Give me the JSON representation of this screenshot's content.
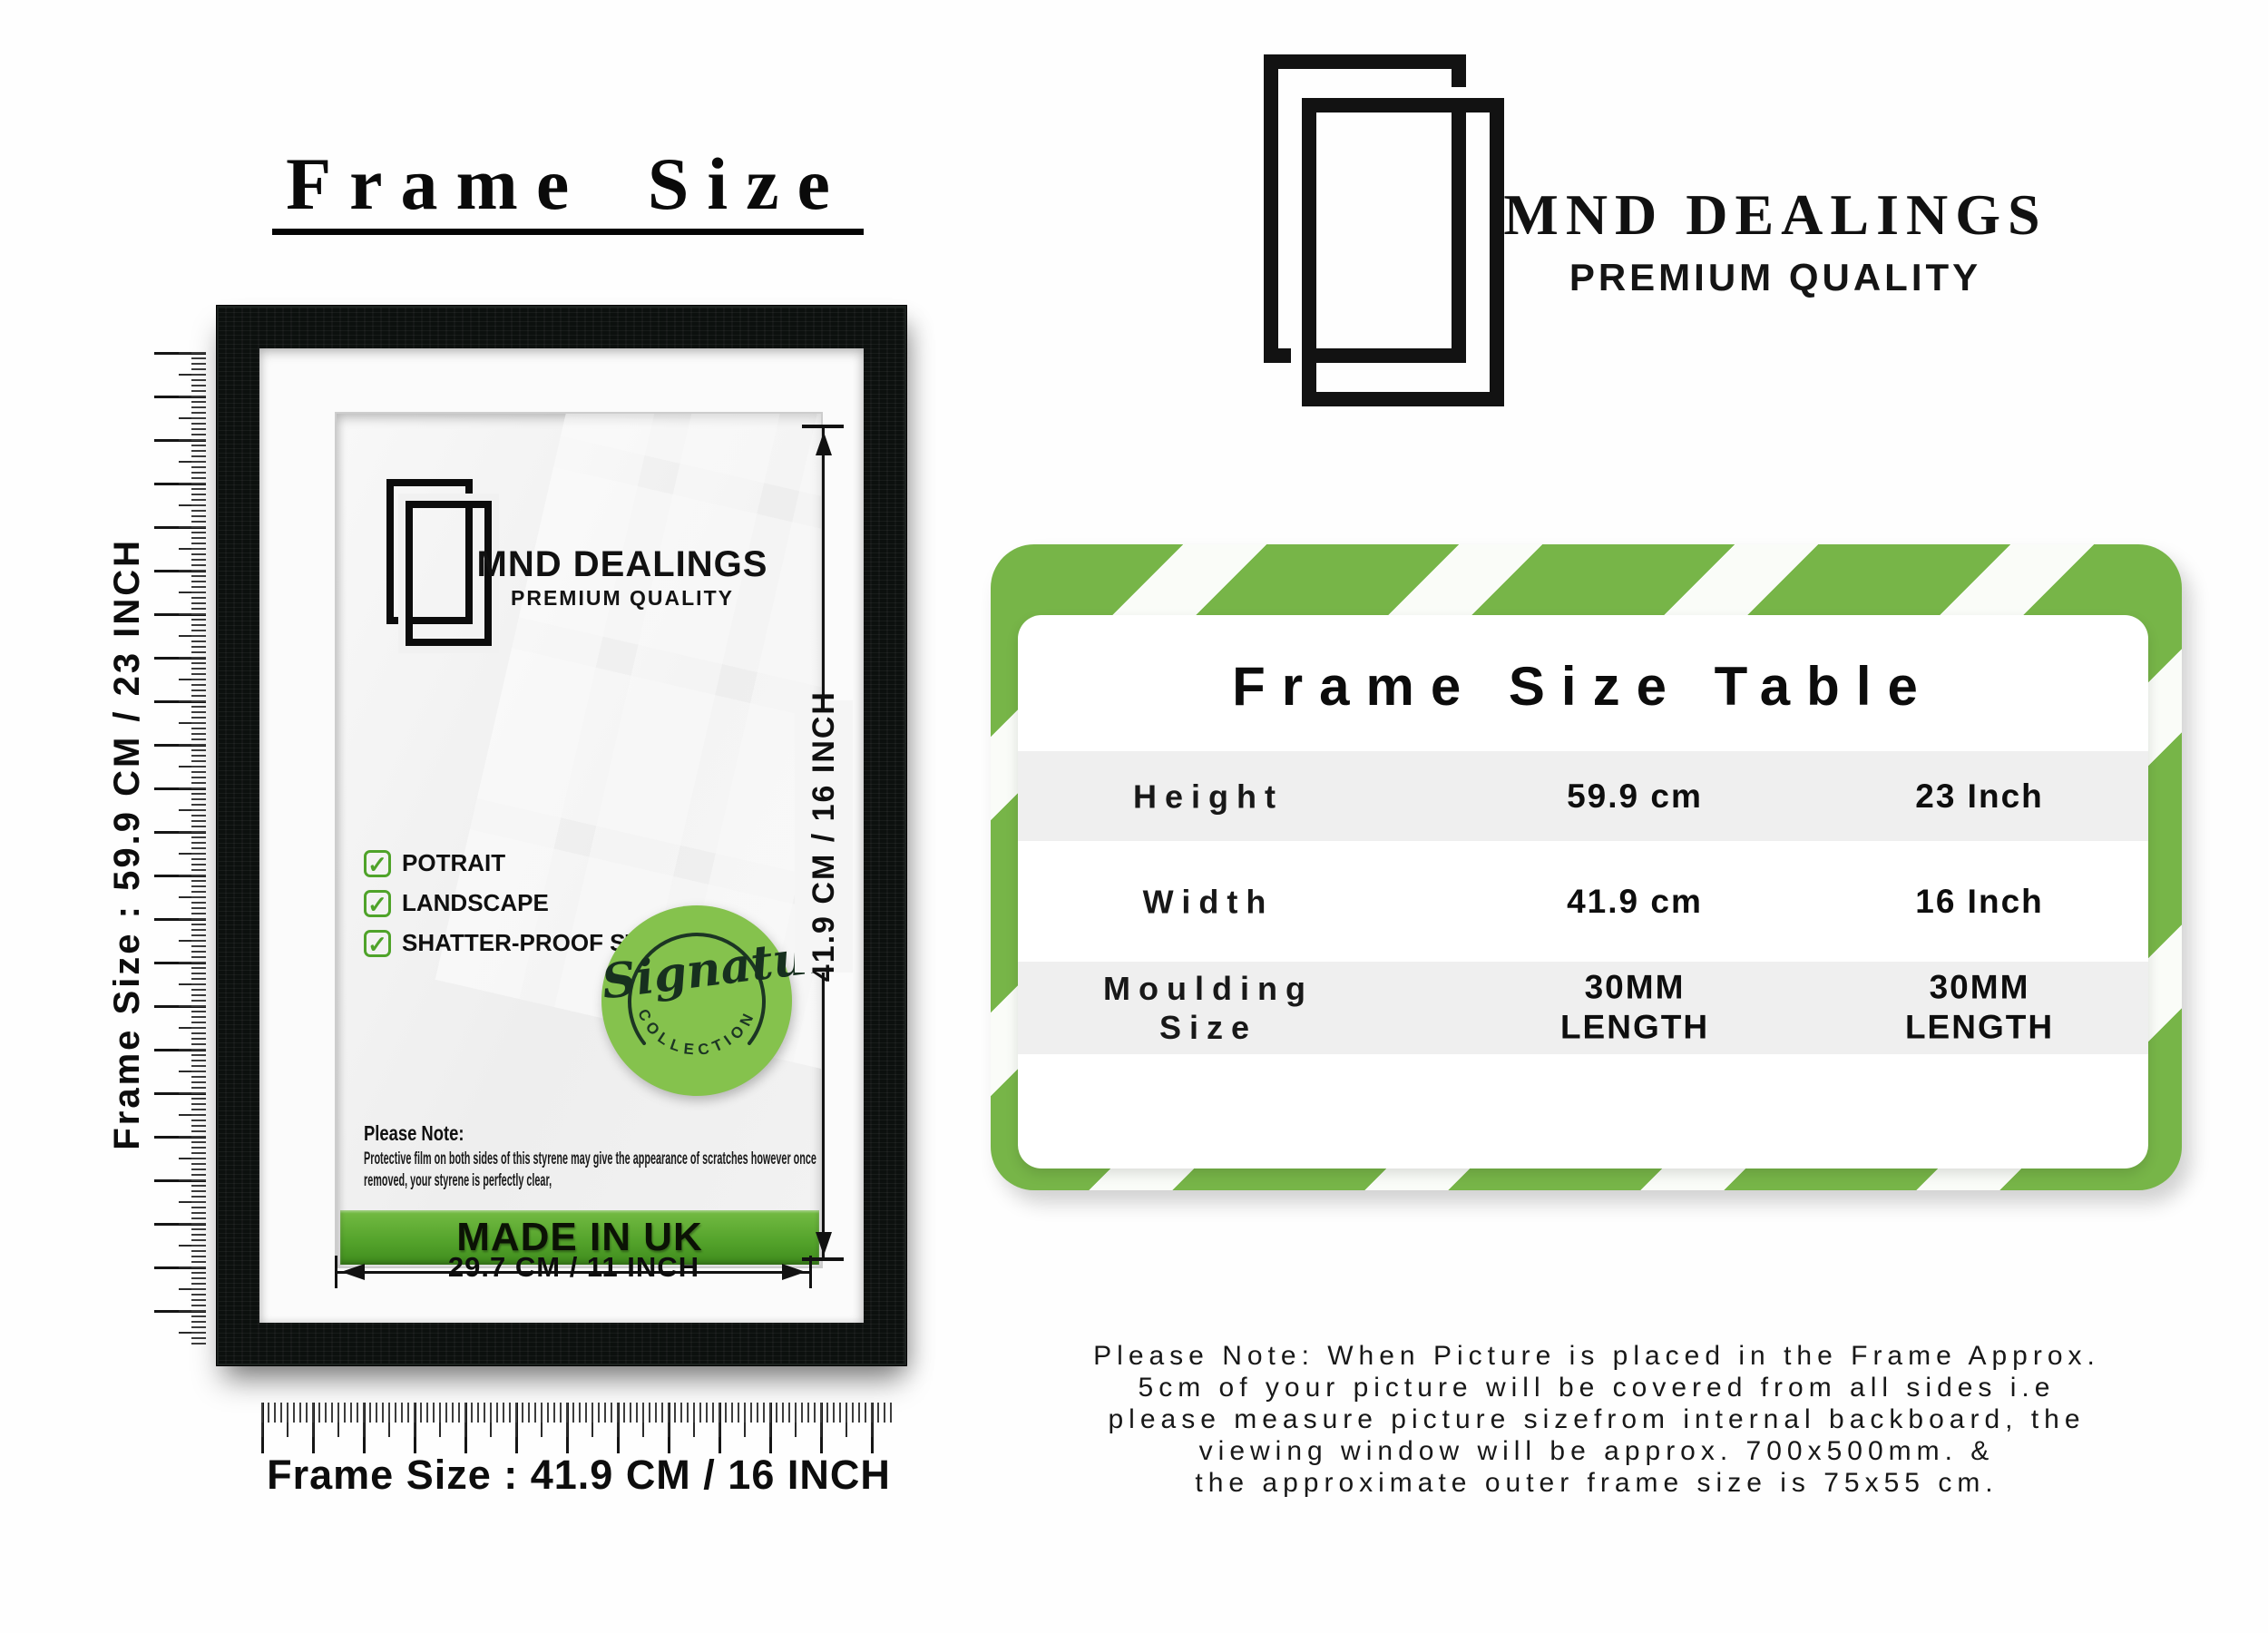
{
  "header": {
    "title": "Frame Size"
  },
  "measurements": {
    "side_label": "Frame Size : 59.9 CM / 23 INCH",
    "bottom_label": "Frame Size : 41.9 CM / 16 INCH",
    "inner_width": "29.7 CM / 11 INCH",
    "inner_height": "41.9 CM / 16 INCH"
  },
  "frame_insert": {
    "brand": "MND DEALINGS",
    "tagline": "PREMIUM QUALITY",
    "features": [
      "POTRAIT",
      "LANDSCAPE",
      "SHATTER-PROOF STYRENE"
    ],
    "badge": {
      "script": "Signature",
      "arc": "COLLECTION"
    },
    "note_heading": "Please Note:",
    "note_lines": [
      "Protective film on both sides of this styrene may give the appearance of scratches however once",
      "removed, your styrene is perfectly clear,"
    ],
    "made_in": "MADE IN UK"
  },
  "brand_header": {
    "name": "MND DEALINGS",
    "tagline": "PREMIUM QUALITY"
  },
  "size_table": {
    "title": "Frame Size Table",
    "rows": [
      {
        "label": "Height",
        "metric": "59.9 cm",
        "imperial": "23 Inch"
      },
      {
        "label": "Width",
        "metric": "41.9 cm",
        "imperial": "16 Inch"
      },
      {
        "label": "Moulding Size",
        "metric": "30MM LENGTH",
        "imperial": "30MM LENGTH"
      }
    ]
  },
  "footnote": {
    "lines": [
      "Please Note: When Picture is placed in the Frame Approx.",
      "5cm of your picture will be covered from all sides i.e",
      "please measure picture sizefrom internal backboard, the",
      "viewing window will be approx. 700x500mm. &",
      "the approximate outer frame size is 75x55 cm."
    ]
  },
  "icons": {
    "check": "✓"
  },
  "colors": {
    "accent_green": "#77b548",
    "badge_green": "#85c24d",
    "banner_green_top": "#74bb43",
    "banner_green_bottom": "#3f8c1d",
    "check_green": "#4fa32a"
  }
}
